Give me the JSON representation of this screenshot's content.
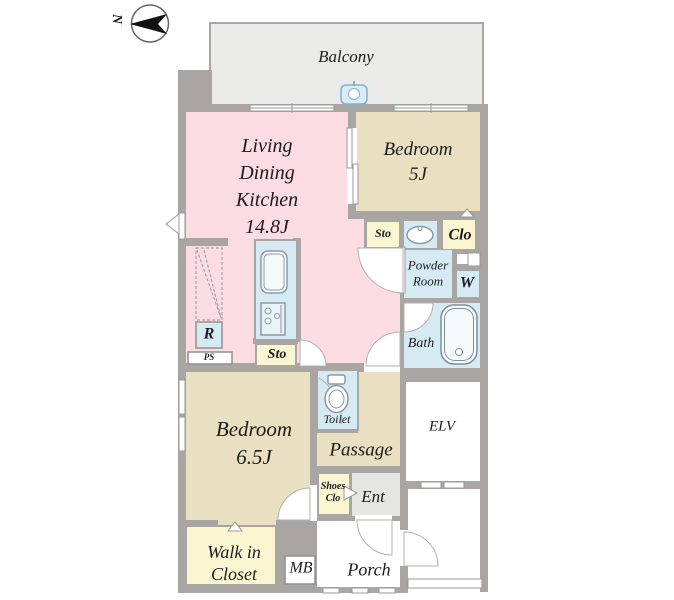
{
  "palette": {
    "wall": "#a8a5a3",
    "room_pink": "#fadce2",
    "room_tan": "#e9dfc1",
    "room_yellow": "#faf6d2",
    "room_blue": "#d5eaf3",
    "balcony_gray": "#eaeae8",
    "entry_gray": "#e5e5e3",
    "text": "#1c1c1c"
  },
  "compass": {
    "north_label": "N"
  },
  "labels": {
    "balcony": "Balcony",
    "ldk_line1": "Living",
    "ldk_line2": "Dining",
    "ldk_line3": "Kitchen",
    "ldk_line4": "14.8J",
    "bedroom5_line1": "Bedroom",
    "bedroom5_line2": "5J",
    "bedroom65_line1": "Bedroom",
    "bedroom65_line2": "6.5J",
    "sto_hall": "Sto",
    "sto_kitchen": "Sto",
    "clo": "Clo",
    "powder_line1": "Powder",
    "powder_line2": "Room",
    "washer": "W",
    "bath": "Bath",
    "refrigerator": "R",
    "pipe_space": "PS",
    "toilet": "Toilet",
    "passage": "Passage",
    "elevator": "ELV",
    "shoes_line1": "Shoes",
    "shoes_line2": "Clo",
    "entrance": "Ent",
    "walk_in_closet_line1": "Walk in",
    "walk_in_closet_line2": "Closet",
    "meter_box": "MB",
    "porch": "Porch"
  }
}
